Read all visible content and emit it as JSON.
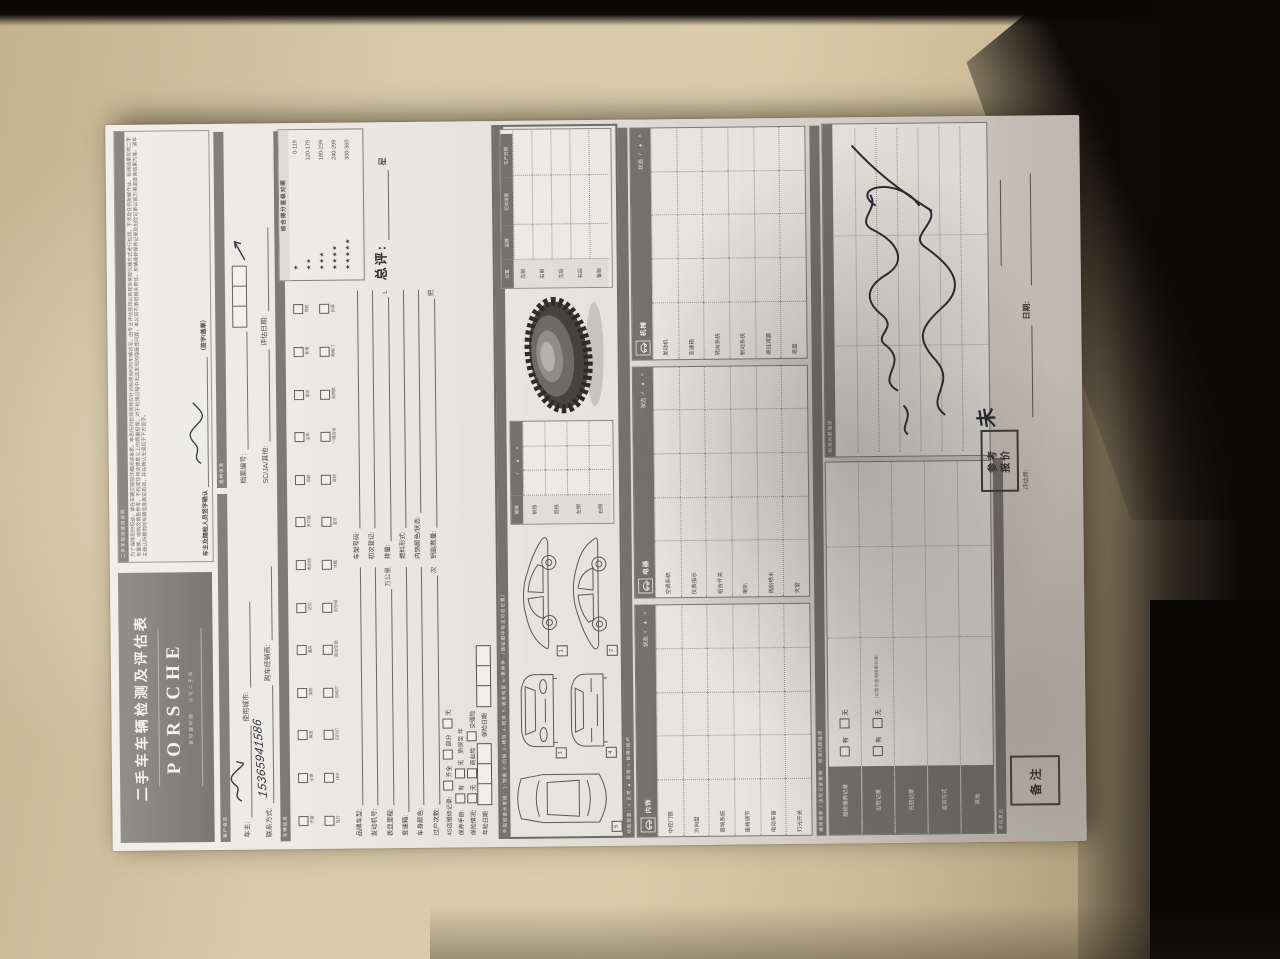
{
  "header": {
    "title": "二手车车辆检测及评估表",
    "brand": "PORSCHE",
    "tagline": "保时捷中国 · 认可二手车",
    "disclaimer_bar": "二手车检测使用说明",
    "disclaimer_text": "为了保障您的权益，请在车辆交接前仔细阅读本表。本表所列检测项目仅针对检测当时的车辆状况，由专业评估技师以目视及常规仪器方式进行检测，不涉及任何拆解作业。检测结果仅供二手车置换、收购及销售参考，不构成任何法律意义上的质量担保。对于检测过程中无法发现的隐蔽性问题，本公司不承担相关责任。车辆维修保养记录及出险记录以官方渠道查询结果为准。请车主确认所提供的车辆信息真实有效，并在确认无误后于下方签字。",
    "confirm_label": "车主及随检人员签字确认",
    "confirm_suffix": "（签字/盖章）"
  },
  "customer": {
    "bar_left": "客户信息",
    "bar_right": "建档信息",
    "owner_label": "车主:",
    "city_label": "使用城市:",
    "phone_label": "联系方式:",
    "phone_value": "15365941586",
    "dealer_label": "购车经销商:",
    "file_no_label": "档案编号:",
    "center_label": "SC/JA/其他:",
    "eval_date_label": "评估日期:"
  },
  "vehicle": {
    "bar": "车辆信息",
    "config_row1": [
      "天窗",
      "全景",
      "真皮",
      "加热",
      "通风",
      "记忆",
      "电动椅",
      "多功能",
      "巡航",
      "泊车",
      "雷达",
      "影像",
      "导航"
    ],
    "config_row2": [
      "氙灯",
      "LED",
      "日行灯",
      "自动灯",
      "自动空调",
      "后空调",
      "冰箱",
      "蓝牙",
      "音响",
      "一键启动",
      "无钥匙",
      "电尾门",
      "抬显"
    ],
    "fields": [
      {
        "label": "品牌车型:"
      },
      {
        "label": "车架号码:"
      },
      {
        "label": "发动机号:"
      },
      {
        "label": "初次登记:"
      },
      {
        "label": "表显里程:",
        "suffix": "万公里"
      },
      {
        "label": "排量:",
        "suffix": "L"
      },
      {
        "label": "变速箱:"
      },
      {
        "label": "燃料形式:"
      },
      {
        "label": "车身颜色:"
      },
      {
        "label": "内饰颜色/状态:"
      },
      {
        "label": "过户次数:",
        "suffix": "次"
      },
      {
        "label": "钥匙数量:",
        "suffix": "把"
      }
    ],
    "checks": [
      {
        "label": "4S店维修记录",
        "options": [
          "齐全",
          "部分",
          "无"
        ]
      },
      {
        "label": "保养手册",
        "options": [
          "有",
          "无"
        ],
        "extra": "质保至         年"
      },
      {
        "label": "保险情况",
        "options": [
          "无",
          "商业险",
          "交强险"
        ]
      }
    ],
    "date_boxes": [
      "年检日期",
      "保险日期"
    ],
    "legend": {
      "title": "综合得分星级对照",
      "rows": [
        {
          "stars": "★",
          "range": "0-119"
        },
        {
          "stars": "★★",
          "range": "120-179"
        },
        {
          "stars": "★★★",
          "range": "180-239"
        },
        {
          "stars": "★★★★",
          "range": "240-299"
        },
        {
          "stars": "★★★★★",
          "range": "300-360"
        }
      ]
    },
    "overall_label": "总评:",
    "overall_unit": "星"
  },
  "diagram": {
    "bar": "外观检查示意图：1-划痕  2-凹陷  3-锈蚀  4-脱漆  5-钣金修复  6-更换件 （请在图中标注对应位置）",
    "view_labels": [
      "1",
      "2",
      "3",
      "4",
      "5"
    ],
    "glass": {
      "corner": "√ ▲ ×",
      "head": "玻璃",
      "rows": [
        "前挡",
        "后挡",
        "左侧",
        "右侧"
      ]
    },
    "tire_table": {
      "header": [
        "位置",
        "品牌",
        "花纹深度",
        "生产日期"
      ],
      "rows": [
        "左前",
        "右前",
        "左后",
        "右后",
        "备胎"
      ]
    }
  },
  "functions": {
    "bar": "功能检查：√ 正常   ▲ 异常   × 故障/损坏",
    "status_label": "状态",
    "status_legend": "√ ▲ ×",
    "tables": [
      {
        "name": "内饰",
        "items": [
          "中控门锁",
          "方向盘",
          "音响系统",
          "座椅调节",
          "电动车窗",
          "灯光开关"
        ]
      },
      {
        "name": "电器",
        "items": [
          "空调系统",
          "仪表指示",
          "组合开关",
          "喇叭",
          "雨刮喷水",
          "天窗"
        ]
      },
      {
        "name": "机械",
        "items": [
          "发动机",
          "变速箱",
          "转向系统",
          "制动系统",
          "悬挂减震",
          "底盘"
        ]
      }
    ]
  },
  "records": {
    "bar": "维修保养 / 出险记录查询 · 检测问题描述",
    "check_options": [
      "有",
      "无"
    ],
    "rows": [
      {
        "label": "维修保养记录",
        "has_check": true,
        "note": ""
      },
      {
        "label": "出险记录",
        "has_check": true,
        "note": "（以官方查询结果为准）"
      },
      {
        "label": "召回记录",
        "has_check": false,
        "note": ""
      },
      {
        "label": "查询方式",
        "has_check": false,
        "note": ""
      },
      {
        "label": "其他",
        "has_check": false,
        "note": ""
      }
    ]
  },
  "problems": {
    "bar": "检测问题描述",
    "handwriting_transcription": "车辆右侧 三个面钣金喷漆"
  },
  "footer": {
    "bar": "评估意见",
    "remark_box": "备注",
    "quote_line1": "参考",
    "quote_line2": "报价",
    "quote_value": "未",
    "assessor_label": "评估师:",
    "date_label": "日期:"
  }
}
